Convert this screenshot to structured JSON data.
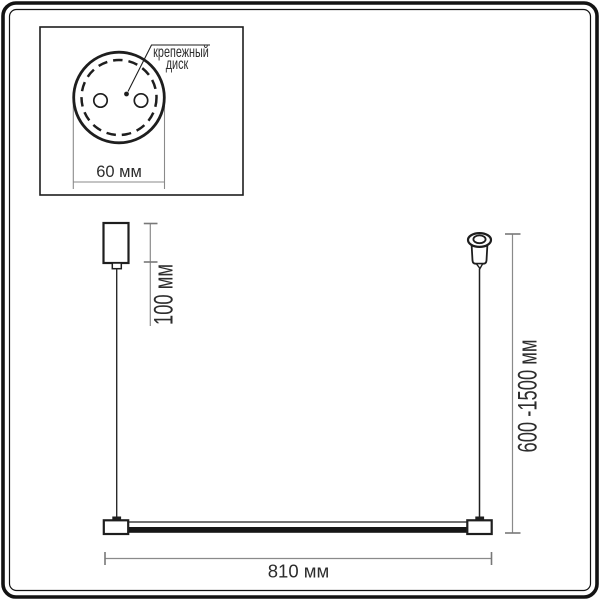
{
  "colors": {
    "background": "#ffffff",
    "drawing_line": "#1e1e1e",
    "dimension_line": "#8a8a8a",
    "text": "#2d2d2d"
  },
  "inset": {
    "callout_line1": "крепежный",
    "callout_line2": "диск",
    "disc_diameter_label": "60 мм"
  },
  "dimensions": {
    "canopy_drop_label": "100 мм",
    "suspension_range_label": "600 -1500 мм",
    "fixture_length_label": "810 мм"
  }
}
